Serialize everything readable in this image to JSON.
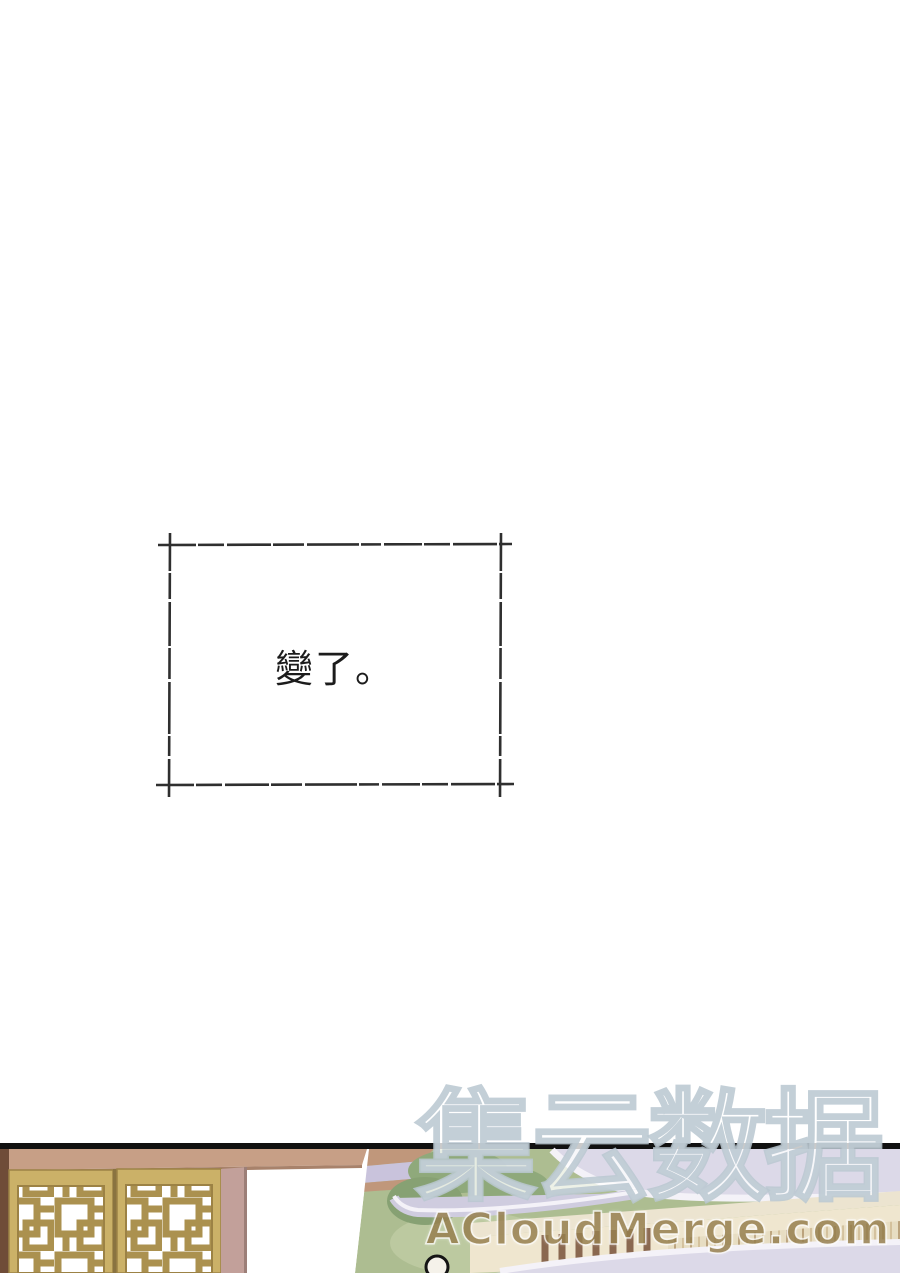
{
  "page": {
    "width": 900,
    "height": 1273,
    "background": "#ffffff"
  },
  "narration_panel": {
    "text": "變了。",
    "border_color": "#2f2f2f",
    "text_color": "#1c1c1c"
  },
  "watermark": {
    "cjk_text": "集云数据",
    "url_text": "ACloudMerge.com",
    "cjk_outline_color": "#b8c7d0",
    "url_color": "#97804f"
  },
  "scene": {
    "description": "traditional courtyard: golden lattice doors, white wall, grass, tiled-roof pavilion, figure head at bottom",
    "colors": {
      "panel_line": "#111111",
      "edge_brown": "#6f4c38",
      "beam_tan": "#c79f86",
      "door_gold": "#cbb168",
      "door_border": "#9c8245",
      "lattice_stroke": "#ab914f",
      "frame_mauve": "#c2a09a",
      "grass_green": "#adbd91",
      "foliage_green": "#8fa97b",
      "walkway_tan": "#c0977b",
      "walkway_lavender": "#c9c3dc",
      "roof_lavender": "#dcd9e8",
      "ridge_white": "#f4f2f8",
      "facade_cream": "#ece4d0",
      "pillar_brown": "#8a6850",
      "railing_cream": "#efe6cf",
      "railing_post": "#b99f7e",
      "narration_text": "#1c1c1c",
      "panel_border": "#2f2f2f",
      "url_color": "#97804f"
    }
  }
}
